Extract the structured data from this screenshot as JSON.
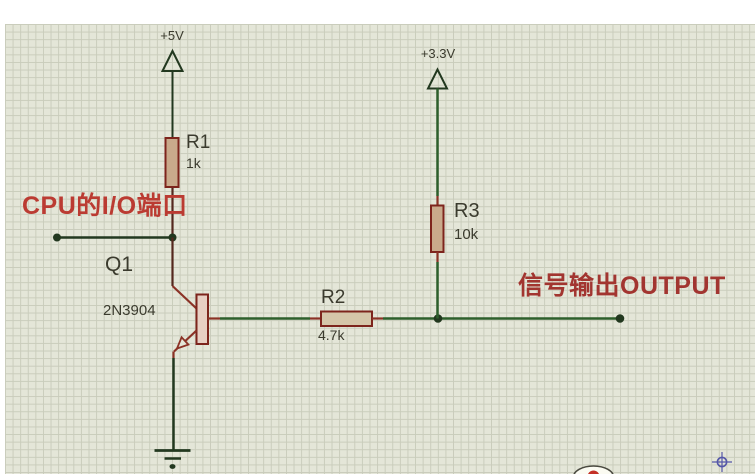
{
  "schematic": {
    "power_rails": [
      {
        "name": "vcc-5v",
        "label": "+5V"
      },
      {
        "name": "vcc-3v3",
        "label": "+3.3V"
      }
    ],
    "components": {
      "r1": {
        "ref": "R1",
        "value": "1k"
      },
      "r2": {
        "ref": "R2",
        "value": "4.7k"
      },
      "r3": {
        "ref": "R3",
        "value": "10k"
      },
      "q1": {
        "ref": "Q1",
        "part": "2N3904"
      }
    },
    "annotations": {
      "cpu_io": "CPU的I/O端口",
      "signal_output": "信号输出OUTPUT"
    }
  },
  "colors": {
    "background": "#e4e6d8",
    "grid_line": "#c9ccbb",
    "wire_dark": "#22381f",
    "wire_green": "#2d5f2b",
    "wire_red_dark": "#54281e",
    "pin_red": "#8b3226",
    "body_stroke": "#7d241c",
    "resistor_fill": "#c9aa8b",
    "resistor_fill_light": "#d5c6a9",
    "transistor_fill": "#e8d0c4",
    "label_dark": "#3b3b2e",
    "annotation_red": "#bb3b32",
    "output_red": "#a23530",
    "marker_blue": "#5557a8",
    "logo_red": "#c43026"
  }
}
